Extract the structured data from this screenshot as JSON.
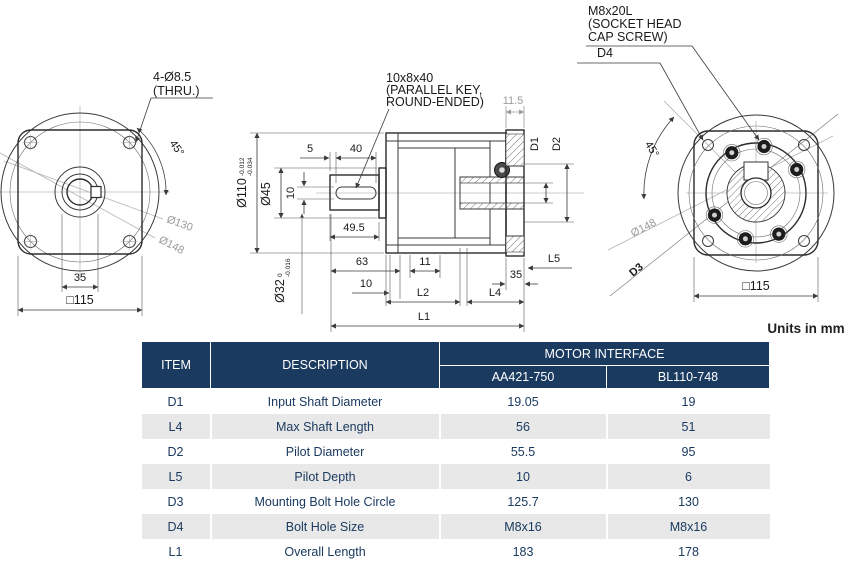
{
  "units_note": "Units in mm",
  "front_view": {
    "label_bolt_holes_line1": "4-Ø8.5",
    "label_bolt_holes_line2": "(THRU.)",
    "dim_45": "45°",
    "dim_d130": "Ø130",
    "dim_d148": "Ø148",
    "dim_35": "35",
    "dim_square115": "□115"
  },
  "section_view": {
    "label_key_line1": "10x8x40",
    "label_key_line2": "(PARALLEL KEY,",
    "label_key_line3": "ROUND-ENDED)",
    "dim_11_5": "11.5",
    "dim_5": "5",
    "dim_40": "40",
    "dim_d110": "Ø110",
    "dim_d110_tol_upper": "-0.012",
    "dim_d110_tol_lower": "-0.034",
    "dim_d45": "Ø45",
    "dim_10_key": "10",
    "dim_49_5": "49.5",
    "dim_d32": "Ø32",
    "dim_d32_tol_upper": "0",
    "dim_d32_tol_lower": "-0.016",
    "dim_63": "63",
    "dim_10": "10",
    "dim_11": "11",
    "dim_35": "35",
    "dim_L5": "L5",
    "dim_L2": "L2",
    "dim_L4": "L4",
    "dim_L1": "L1",
    "dim_D1": "D1",
    "dim_D2": "D2"
  },
  "rear_view": {
    "label_screw_line1": "M8x20L",
    "label_screw_line2": "(SOCKET HEAD",
    "label_screw_line3": "CAP SCREW)",
    "label_D4": "D4",
    "dim_45": "45°",
    "dim_d148": "Ø148",
    "label_D3": "D3",
    "dim_square115": "□115"
  },
  "table": {
    "headers": {
      "item": "ITEM",
      "description": "DESCRIPTION",
      "group": "MOTOR INTERFACE",
      "col1": "AA421-750",
      "col2": "BL110-748"
    },
    "rows": [
      {
        "item": "D1",
        "description": "Input Shaft Diameter",
        "aa421_750": "19.05",
        "bl110_748": "19"
      },
      {
        "item": "L4",
        "description": "Max Shaft Length",
        "aa421_750": "56",
        "bl110_748": "51"
      },
      {
        "item": "D2",
        "description": "Pilot Diameter",
        "aa421_750": "55.5",
        "bl110_748": "95"
      },
      {
        "item": "L5",
        "description": "Pilot Depth",
        "aa421_750": "10",
        "bl110_748": "6"
      },
      {
        "item": "D3",
        "description": "Mounting Bolt Hole Circle",
        "aa421_750": "125.7",
        "bl110_748": "130"
      },
      {
        "item": "D4",
        "description": "Bolt Hole Size",
        "aa421_750": "M8x16",
        "bl110_748": "M8x16"
      },
      {
        "item": "L1",
        "description": "Overall Length",
        "aa421_750": "183",
        "bl110_748": "178"
      }
    ]
  },
  "colors": {
    "header_bg": "#1b3a60",
    "row_alt": "#e8e8e8",
    "text_navy": "#1b3a60",
    "line": "#3a3a3a",
    "dim_gray": "#9a9a9a"
  }
}
